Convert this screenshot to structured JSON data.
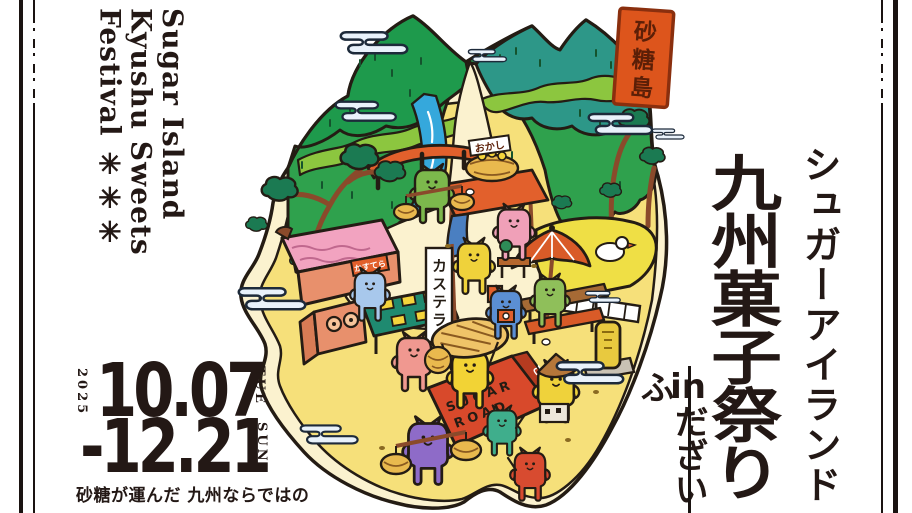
{
  "left_title": {
    "line1": "Sugar Island",
    "line2": "Kyushu Sweets",
    "line3": "Festival ✳✳✳"
  },
  "dates": {
    "year": "2025",
    "start": "10.07",
    "start_day": "TUE",
    "end": "-12.21",
    "end_day": "SUN",
    "tagline": "砂糖が運んだ 九州ならではの"
  },
  "right_title": {
    "subtitle": "シュガーアイランド",
    "title": "九州菓子祭り",
    "location_prefix": "in",
    "location": "だざいふ"
  },
  "island": {
    "flag_chars": [
      "砂",
      "糖",
      "島"
    ],
    "banner": "カステラ",
    "stall_sign": "おかし",
    "shop_sign": "かすてら",
    "road_line1": "SUGAR",
    "road_line2": "ROAD",
    "road_side": "さとう"
  },
  "colors": {
    "ink": "#231815",
    "sand": "#F6E07A",
    "beach": "#FBF2CF",
    "green_mid": "#2FA14D",
    "green_dark": "#1E9A4C",
    "green_light": "#8CC63F",
    "teal_mountain": "#2D9788",
    "river": "#35A8DC",
    "flag_orange": "#DD551C",
    "carpet_red": "#D8492B",
    "cloud": "#E9F2FB"
  }
}
